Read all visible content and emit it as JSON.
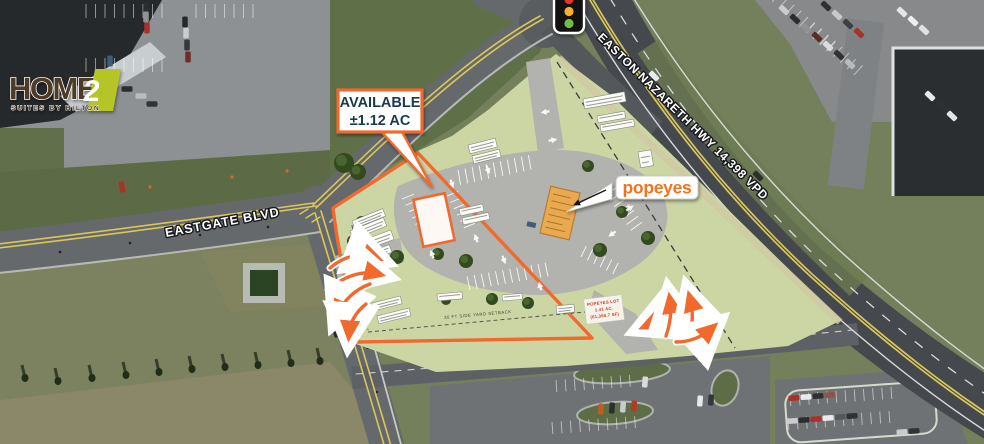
{
  "logo": {
    "word": "HOME",
    "numeral": "2",
    "tagline": "SUITES BY HILTON"
  },
  "callout": {
    "title": "AVAILABLE",
    "area": "±1.12 AC"
  },
  "roads": {
    "eastgate": "EASTGATE BLVD",
    "highway": "EASTON NAZARETH HWY 14,398 VPD"
  },
  "popeyes": {
    "logo": "popeyes",
    "lot_line1": "POPEYES LOT",
    "lot_line2": "1.41 AC.",
    "lot_line3": "(61,368.7 SF)"
  },
  "setbacks": {
    "south": "30 FT SIDE YARD SETBACK",
    "west": "WEST SIDE YARD SETBACK"
  },
  "theme": {
    "accent_orange": "#F2692E",
    "popeyes_orange": "#F4731F",
    "lime_green": "#B5C427",
    "navy": "#1B3A4C",
    "label_red": "#C93A2B",
    "site_green": "#CCD6A4"
  }
}
